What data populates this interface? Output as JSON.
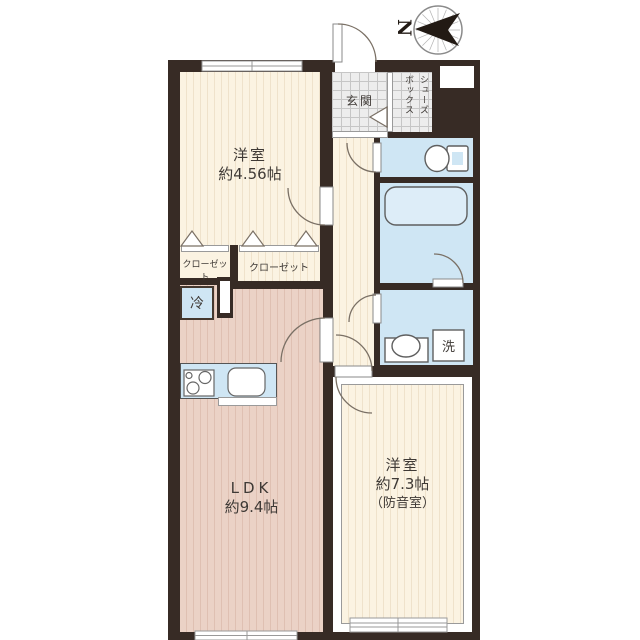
{
  "compass": {
    "label": "N"
  },
  "rooms": {
    "western_room_1": {
      "name": "洋室",
      "size": "約4.56帖"
    },
    "ldk": {
      "name": "LDK",
      "size": "約9.4帖"
    },
    "western_room_2": {
      "name": "洋室",
      "size": "約7.3帖",
      "note": "（防音室）"
    },
    "entrance": {
      "label": "玄関"
    },
    "shoe_box": {
      "line1": "シューズ",
      "line2": "ボックス"
    },
    "closet_left": {
      "label": "クローゼット"
    },
    "closet_right": {
      "label": "クローゼット"
    }
  },
  "fixtures": {
    "refrigerator": {
      "label": "冷"
    },
    "washing_machine": {
      "label": "洗"
    }
  },
  "icons": {
    "compass": "compass-rose-icon",
    "toilet": "toilet-icon",
    "bathtub": "bathtub-icon",
    "washbasin": "washbasin-icon",
    "stove": "stove-burners-icon",
    "sink": "kitchen-sink-icon"
  },
  "colors": {
    "wall": "#372b25",
    "wood_floor": "#fbf3e2",
    "ldk_floor": "#ebd2c6",
    "water_area": "#cfe6f4",
    "entrance_tile": "#ededed"
  }
}
